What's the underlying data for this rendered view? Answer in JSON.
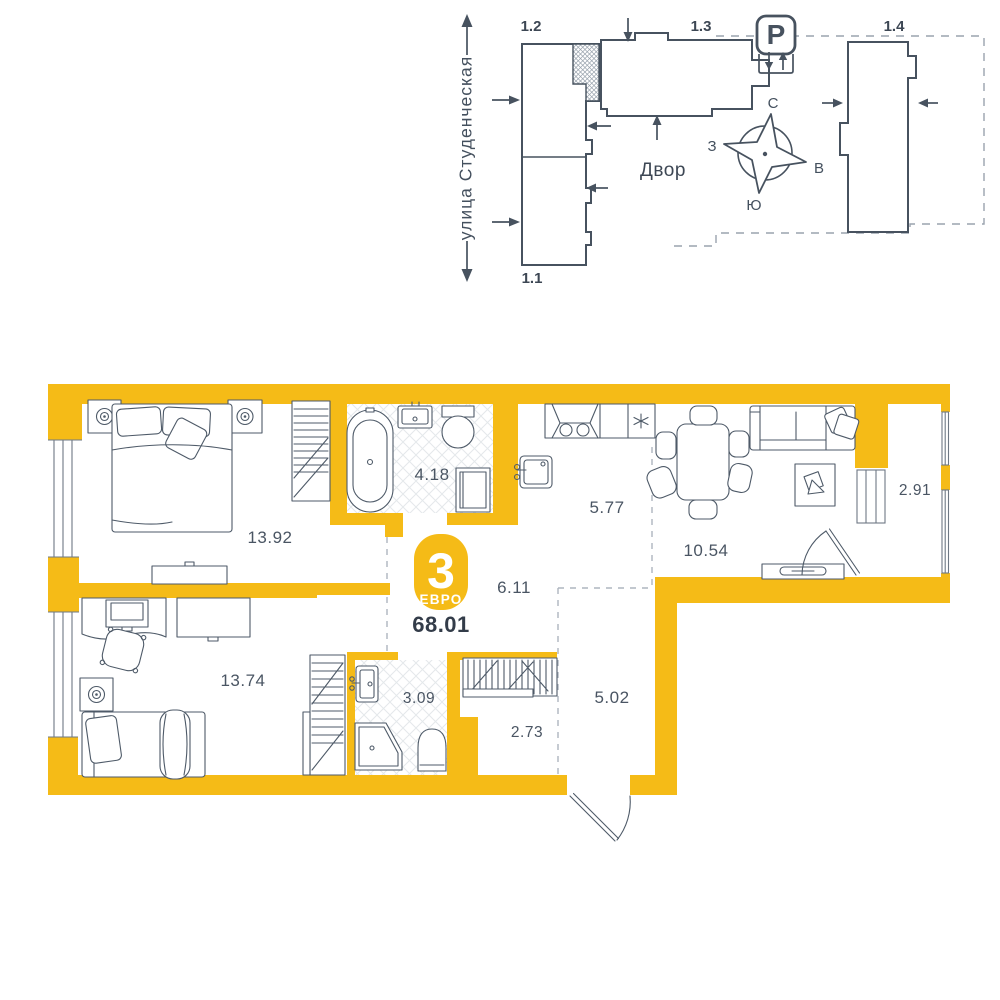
{
  "site_plan": {
    "street_label": "улица Студенческая",
    "courtyard_label": "Двор",
    "parking_symbol": "P",
    "buildings": {
      "b11": "1.1",
      "b12": "1.2",
      "b13": "1.3",
      "b14": "1.4"
    },
    "compass": {
      "north": "С",
      "south": "Ю",
      "west": "З",
      "east": "В"
    }
  },
  "apartment": {
    "badge": {
      "rooms_count": "3",
      "layout_type": "ЕВРО"
    },
    "total_area": "68.01",
    "rooms": {
      "bedroom_1": "13.92",
      "bathroom_1": "4.18",
      "kitchen": "5.77",
      "living_dining": "10.54",
      "balcony": "2.91",
      "hallway": "6.11",
      "bedroom_2": "13.74",
      "bathroom_2": "3.09",
      "wardrobe": "2.73",
      "entry_hall": "5.02"
    },
    "fridge_symbol": "✳"
  },
  "colors": {
    "accent": "#F5BB17",
    "line": "#47525F"
  }
}
